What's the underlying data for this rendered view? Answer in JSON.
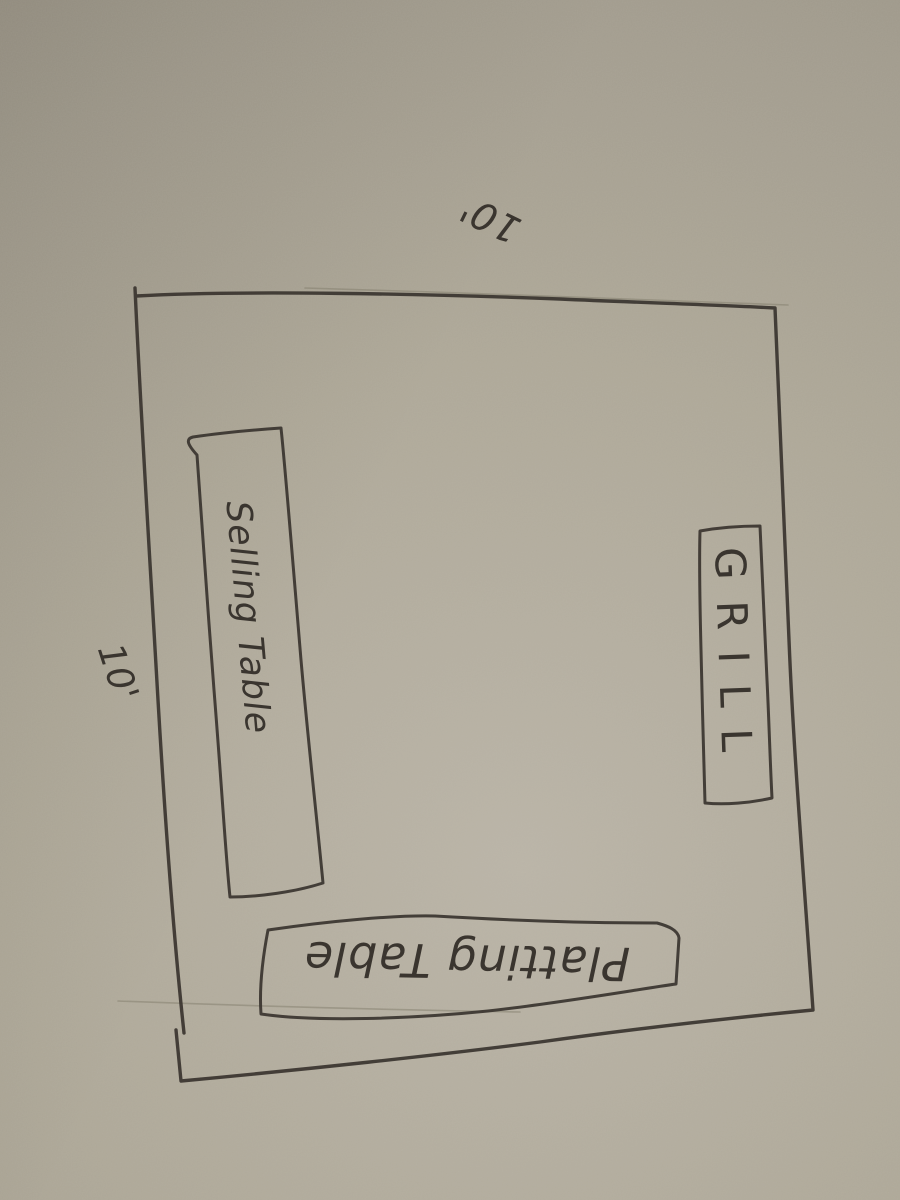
{
  "sketch": {
    "dimensions": {
      "top": "10'",
      "left": "10'"
    },
    "furniture": [
      {
        "id": "selling-table",
        "label": "Selling Table"
      },
      {
        "id": "grill",
        "label": "GRILL"
      },
      {
        "id": "platting-table",
        "label": "Platting Table"
      }
    ],
    "colors": {
      "paper": "#aea898",
      "ink": "#3a352f"
    }
  }
}
